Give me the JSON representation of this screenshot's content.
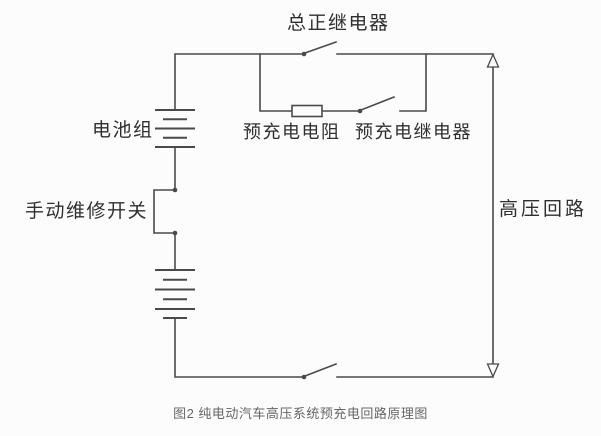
{
  "figure": {
    "background_color": "#fcfcfc",
    "line_color": "#4a4a4a",
    "label_color": "#2f2f2f",
    "caption_color": "#666666",
    "labels": {
      "main_positive_relay": "总正继电器",
      "battery_pack": "电池组",
      "precharge_resistor": "预充电电阻",
      "precharge_relay": "预充电继电器",
      "manual_service_switch": "手动维修开关",
      "high_voltage_loop": "高压回路"
    },
    "caption": "图2 纯电动汽车高压系统预充电回路原理图"
  }
}
